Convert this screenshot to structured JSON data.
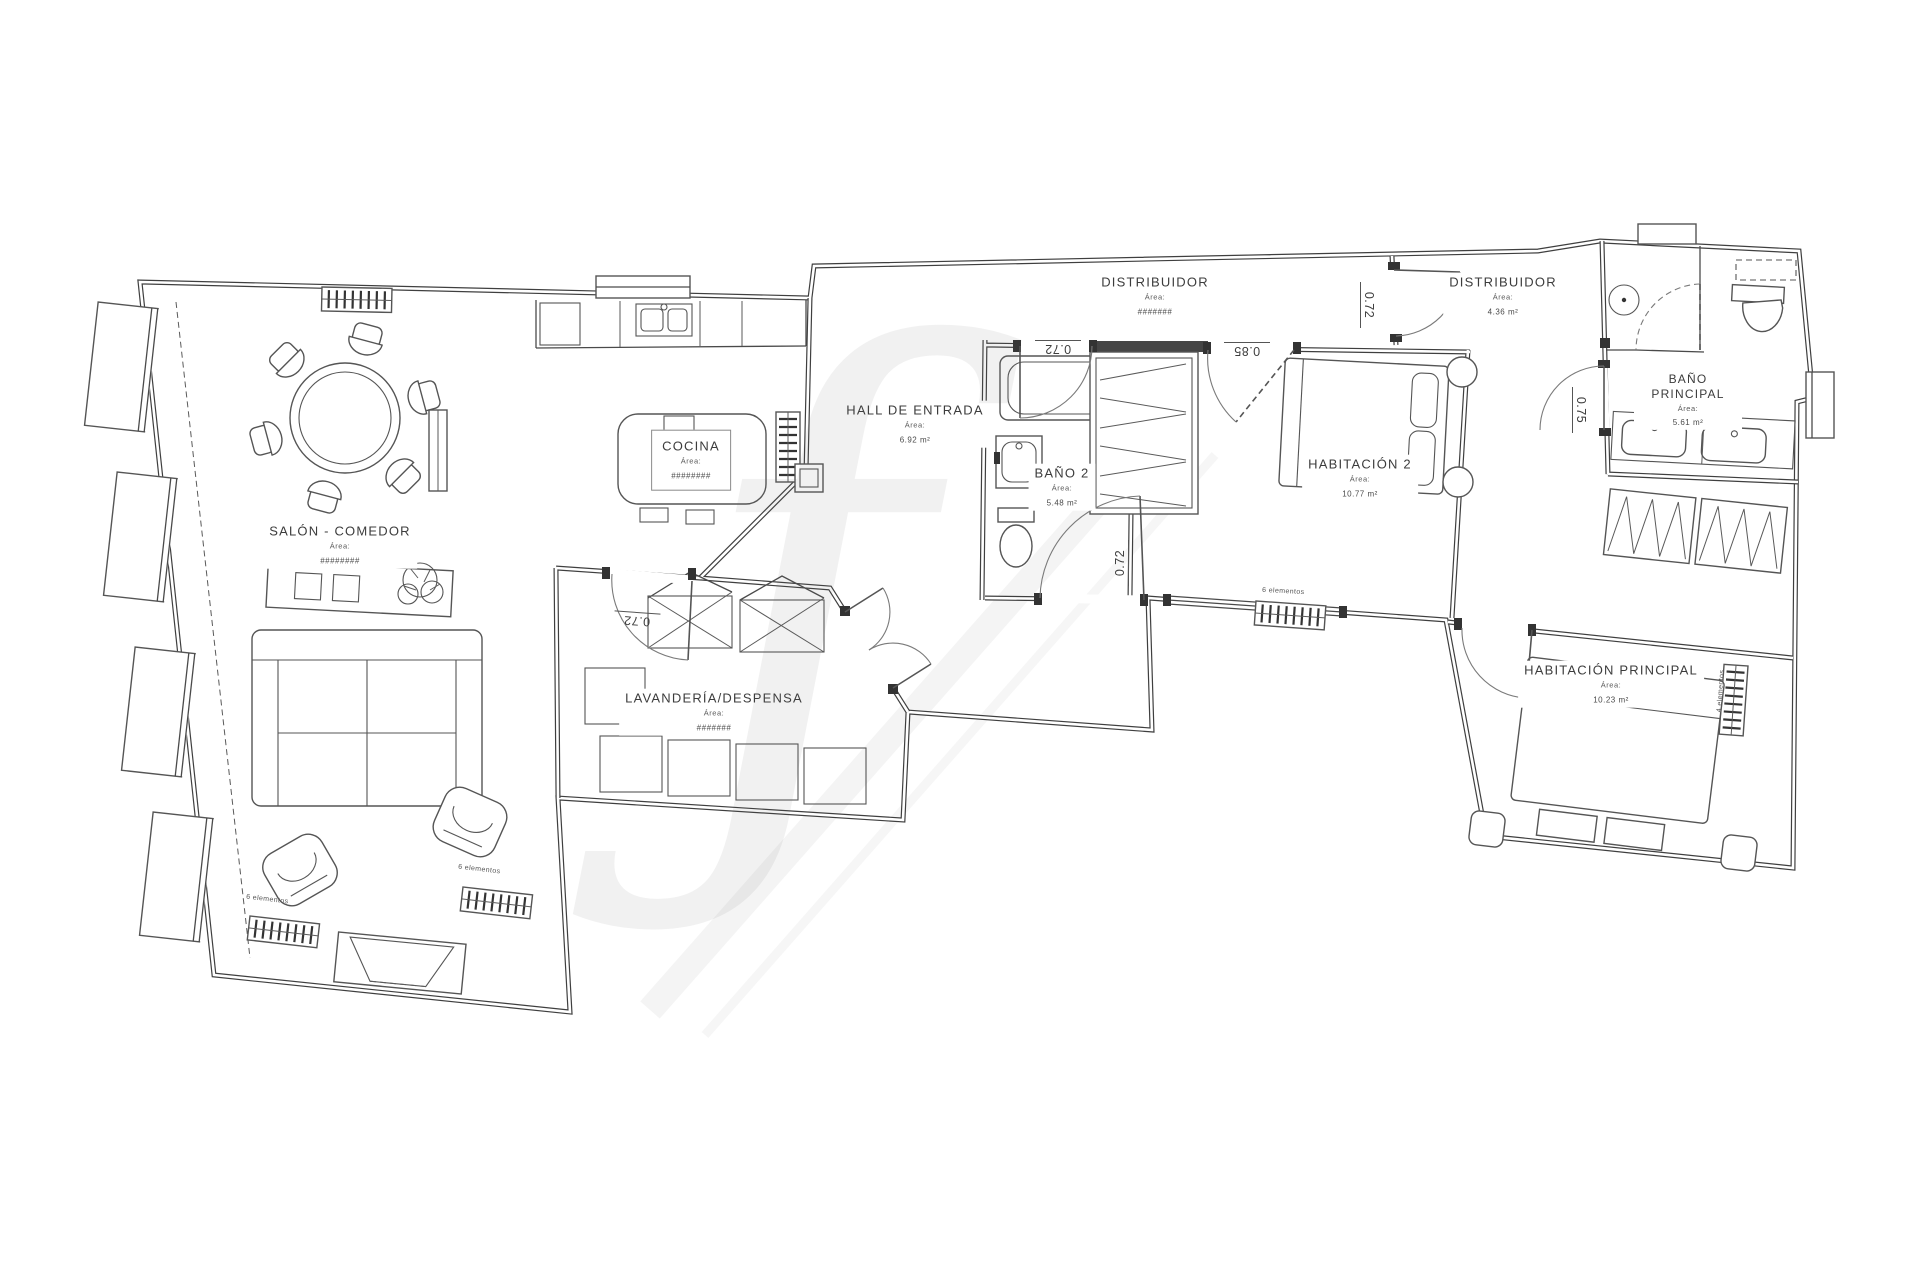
{
  "rooms": {
    "salon": {
      "name": "SALÓN - COMEDOR",
      "area_label": "Área:",
      "area_value": "########"
    },
    "cocina": {
      "name": "COCINA",
      "area_label": "Área:",
      "area_value": "########"
    },
    "hall": {
      "name": "HALL DE ENTRADA",
      "area_label": "Área:",
      "area_value": "6.92 m²"
    },
    "bano2": {
      "name": "BAÑO 2",
      "area_label": "Área:",
      "area_value": "5.48 m²"
    },
    "distribuidor1": {
      "name": "DISTRIBUIDOR",
      "area_label": "Área:",
      "area_value": "#######"
    },
    "distribuidor2": {
      "name": "DISTRIBUIDOR",
      "area_label": "Área:",
      "area_value": "4.36 m²"
    },
    "habitacion2": {
      "name": "HABITACIÓN 2",
      "area_label": "Área:",
      "area_value": "10.77 m²"
    },
    "bano_principal": {
      "name": "BAÑO PRINCIPAL",
      "area_label": "Área:",
      "area_value": "5.61 m²"
    },
    "habitacion_principal": {
      "name": "HABITACIÓN PRINCIPAL",
      "area_label": "Área:",
      "area_value": "10.23 m²"
    },
    "lavanderia": {
      "name": "LAVANDERÍA/DESPENSA",
      "area_label": "Área:",
      "area_value": "#######"
    }
  },
  "dimensions": {
    "bano2_door": {
      "value": "0.72"
    },
    "habitacion2_door": {
      "value": "0.85"
    },
    "distribuidor_door": {
      "value": "0.72"
    },
    "bano_principal_door": {
      "value": "0.75"
    },
    "bano2_inner_door": {
      "value": "0.72"
    },
    "lavanderia_door": {
      "value": "0.72"
    }
  },
  "radiators": {
    "salon_left": {
      "label": "6 elementos"
    },
    "salon_right": {
      "label": "6 elementos"
    },
    "habitacion2": {
      "label": "6 elementos"
    },
    "habitacion_principal": {
      "label": "4 elementos"
    }
  },
  "watermark": {
    "glyph": "ƒ"
  }
}
